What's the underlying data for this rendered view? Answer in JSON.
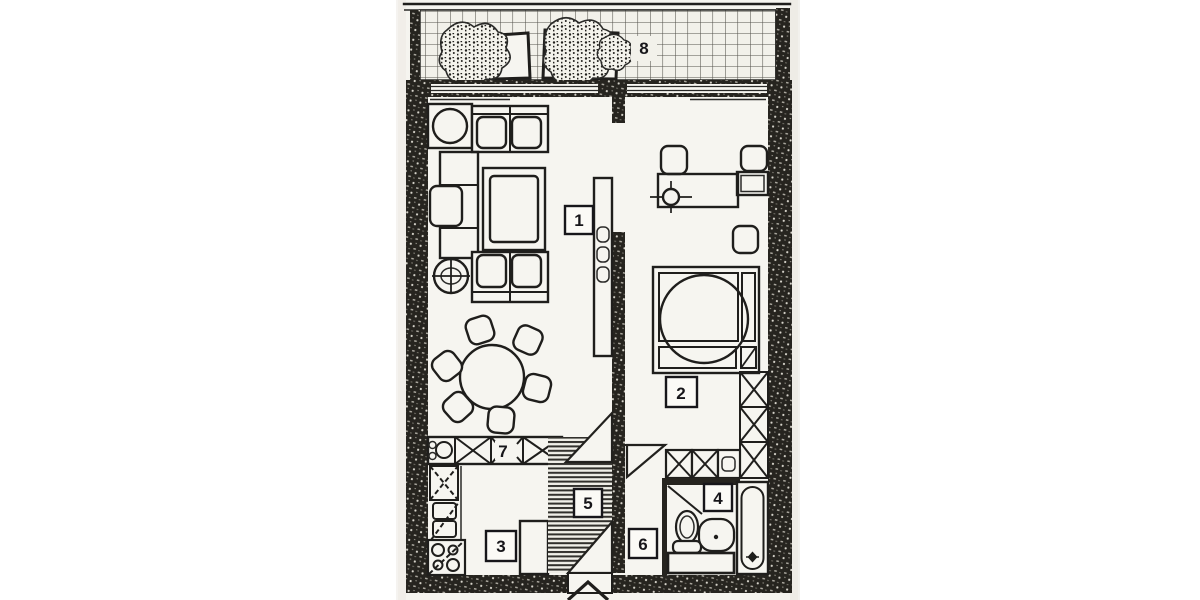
{
  "colors": {
    "paper": "#f5f4ef",
    "ink": "#1f1e1c",
    "wall": "#26241f",
    "grid_line": "#54524c"
  },
  "rooms": [
    {
      "number": "1"
    },
    {
      "number": "2"
    },
    {
      "number": "3"
    },
    {
      "number": "4"
    },
    {
      "number": "5"
    },
    {
      "number": "6"
    },
    {
      "number": "7"
    },
    {
      "number": "8"
    }
  ]
}
